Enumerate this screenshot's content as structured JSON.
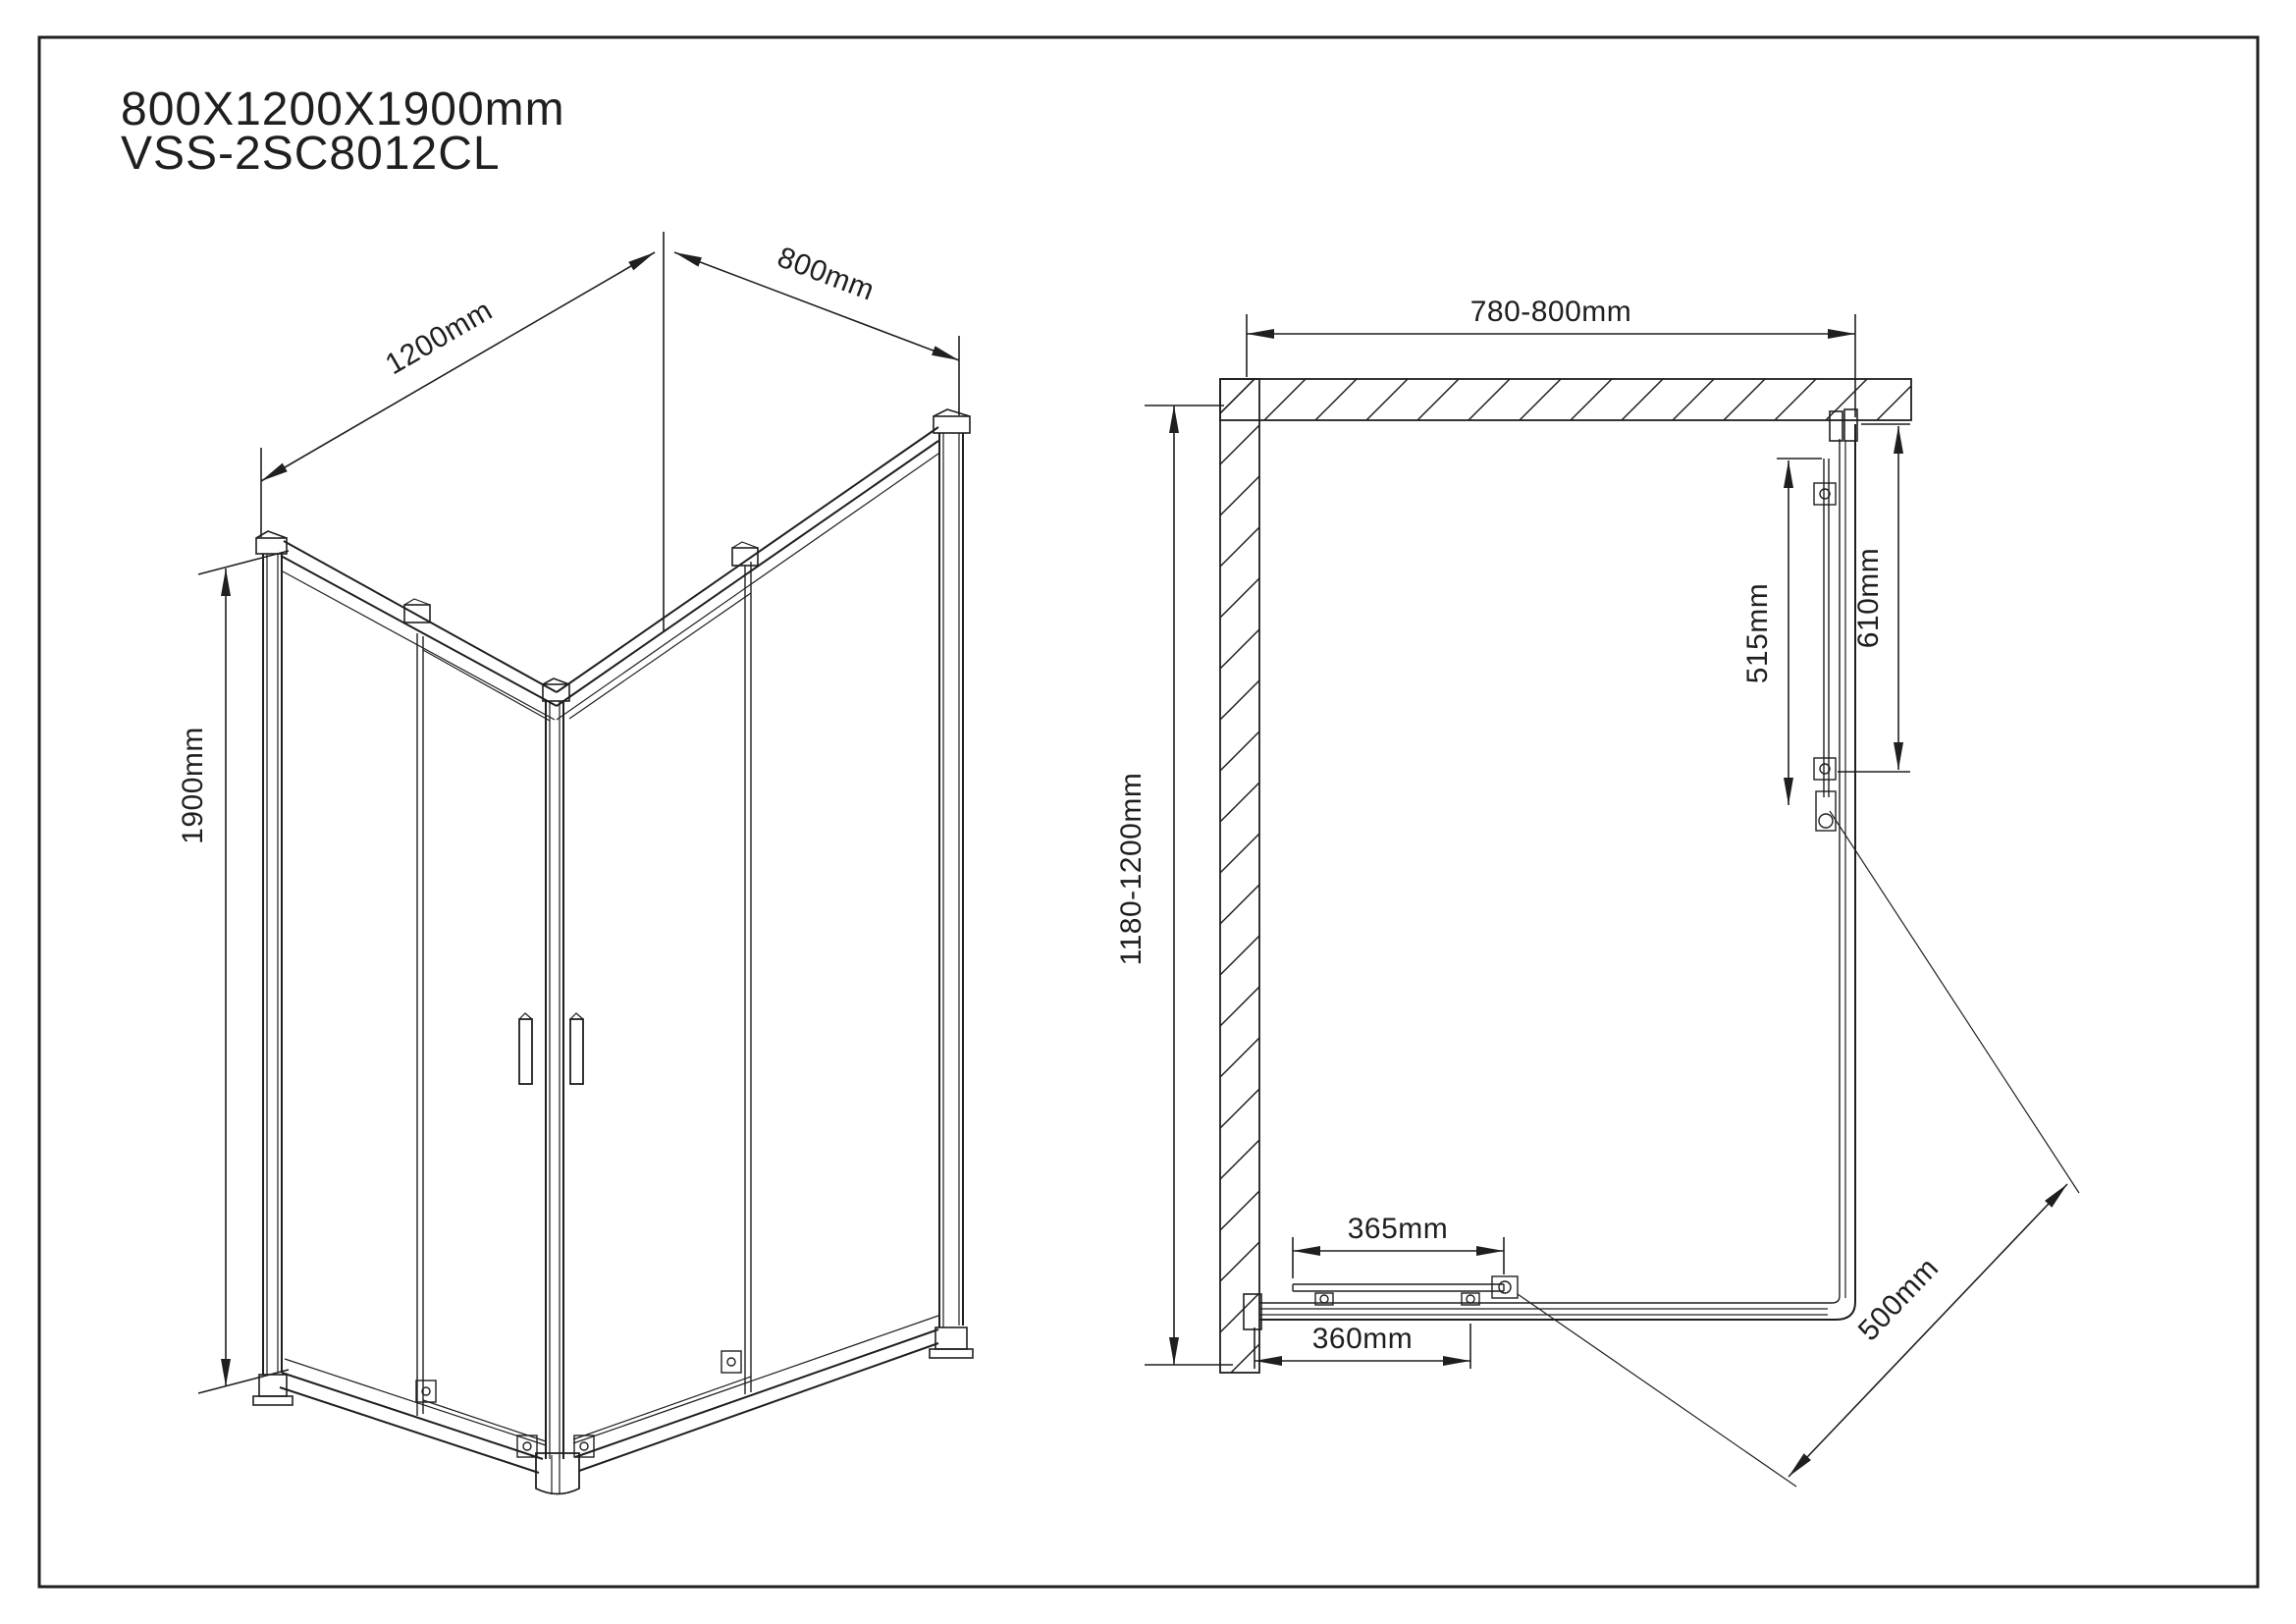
{
  "title": {
    "line1": "800X1200X1900mm",
    "line2": "VSS-2SC8012CL"
  },
  "isometric_view": {
    "dim_width_label": "1200mm",
    "dim_depth_label": "800mm",
    "dim_height_label": "1900mm"
  },
  "plan_view": {
    "dim_top_wall_label": "780-800mm",
    "dim_left_wall_label": "1180-1200mm",
    "dim_side_outer_label": "610mm",
    "dim_side_inner_label": "515mm",
    "dim_bottom_upper_label": "365mm",
    "dim_bottom_lower_label": "360mm",
    "dim_diagonal_entry_label": "500mm"
  },
  "colors": {
    "line": "#1f1f1f",
    "background": "#ffffff"
  }
}
